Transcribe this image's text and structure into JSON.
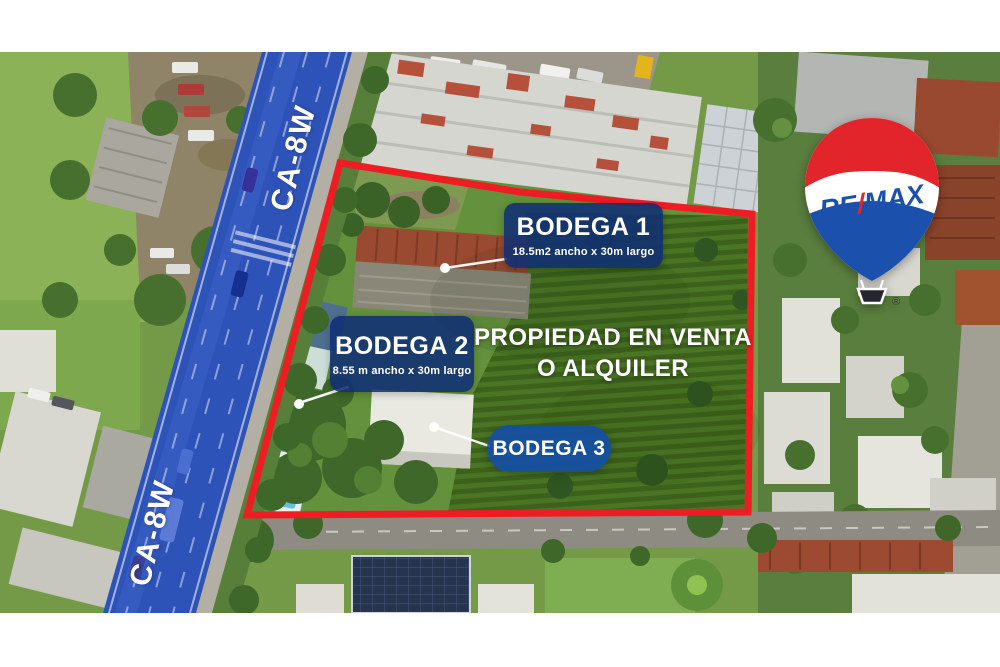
{
  "road": {
    "name": "CA-8W",
    "label_top": "CA-8W",
    "label_bottom": "CA-8W",
    "overlay_color": "#2e53b8"
  },
  "property": {
    "headline_line1": "PROPIEDAD EN VENTA",
    "headline_line2": "O ALQUILER",
    "boundary_color": "#ee1c23",
    "label_background": "rgba(16,47,116,0.88)"
  },
  "bodegas": [
    {
      "title": "BODEGA 1",
      "dimensions": "18.5m2 ancho x 30m largo"
    },
    {
      "title": "BODEGA 2",
      "dimensions": "8.55 m ancho x 30m largo"
    },
    {
      "title": "BODEGA 3"
    }
  ],
  "brand": {
    "re": "RE",
    "slash": "/",
    "max": "MAX",
    "registered": "®",
    "red": "#e2242b",
    "blue": "#1b50ac"
  }
}
